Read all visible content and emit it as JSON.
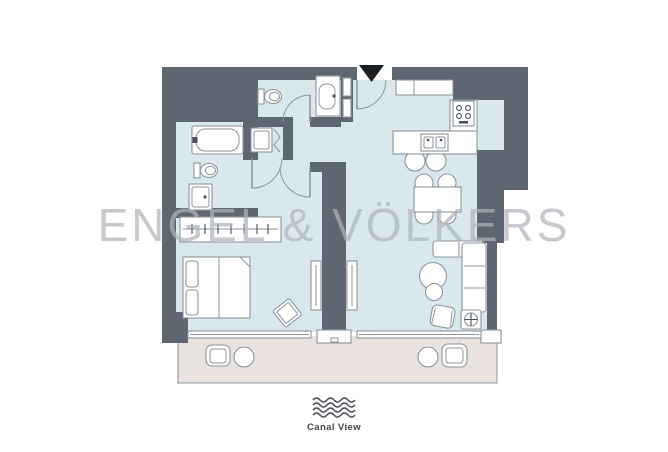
{
  "watermark": {
    "text": "ENGEL & VÖLKERS"
  },
  "footer": {
    "label": "Canal View",
    "icon": "waves-icon"
  },
  "colors": {
    "background": "#ffffff",
    "wall": "#5e6671",
    "floor": "#d9e8ed",
    "balcony_floor": "#e9e2de",
    "fixture_fill": "#ffffff",
    "fixture_stroke": "#8d959c",
    "fixture_detail": "#4a5057",
    "watermark_text": "rgba(175,180,186,0.72)",
    "entrance_marker": "#1d2023",
    "footer_text": "#41464c"
  },
  "floorplan": {
    "view_label_icon": "waves-icon",
    "entrance": "entrance-marker",
    "features": [
      "entry-closet",
      "guest-toilet",
      "guest-sink",
      "washer",
      "bathtub",
      "toilet",
      "shower",
      "wardrobe",
      "double-bed",
      "ottoman",
      "sliding-door-panels",
      "kitchen-counter",
      "fridge",
      "stove",
      "island-sink",
      "bar-stools",
      "dining-table",
      "dining-chairs",
      "l-sofa",
      "round-coffee-tables",
      "armchair",
      "plant-side-table",
      "balcony",
      "balcony-tables",
      "balcony-chairs"
    ]
  }
}
